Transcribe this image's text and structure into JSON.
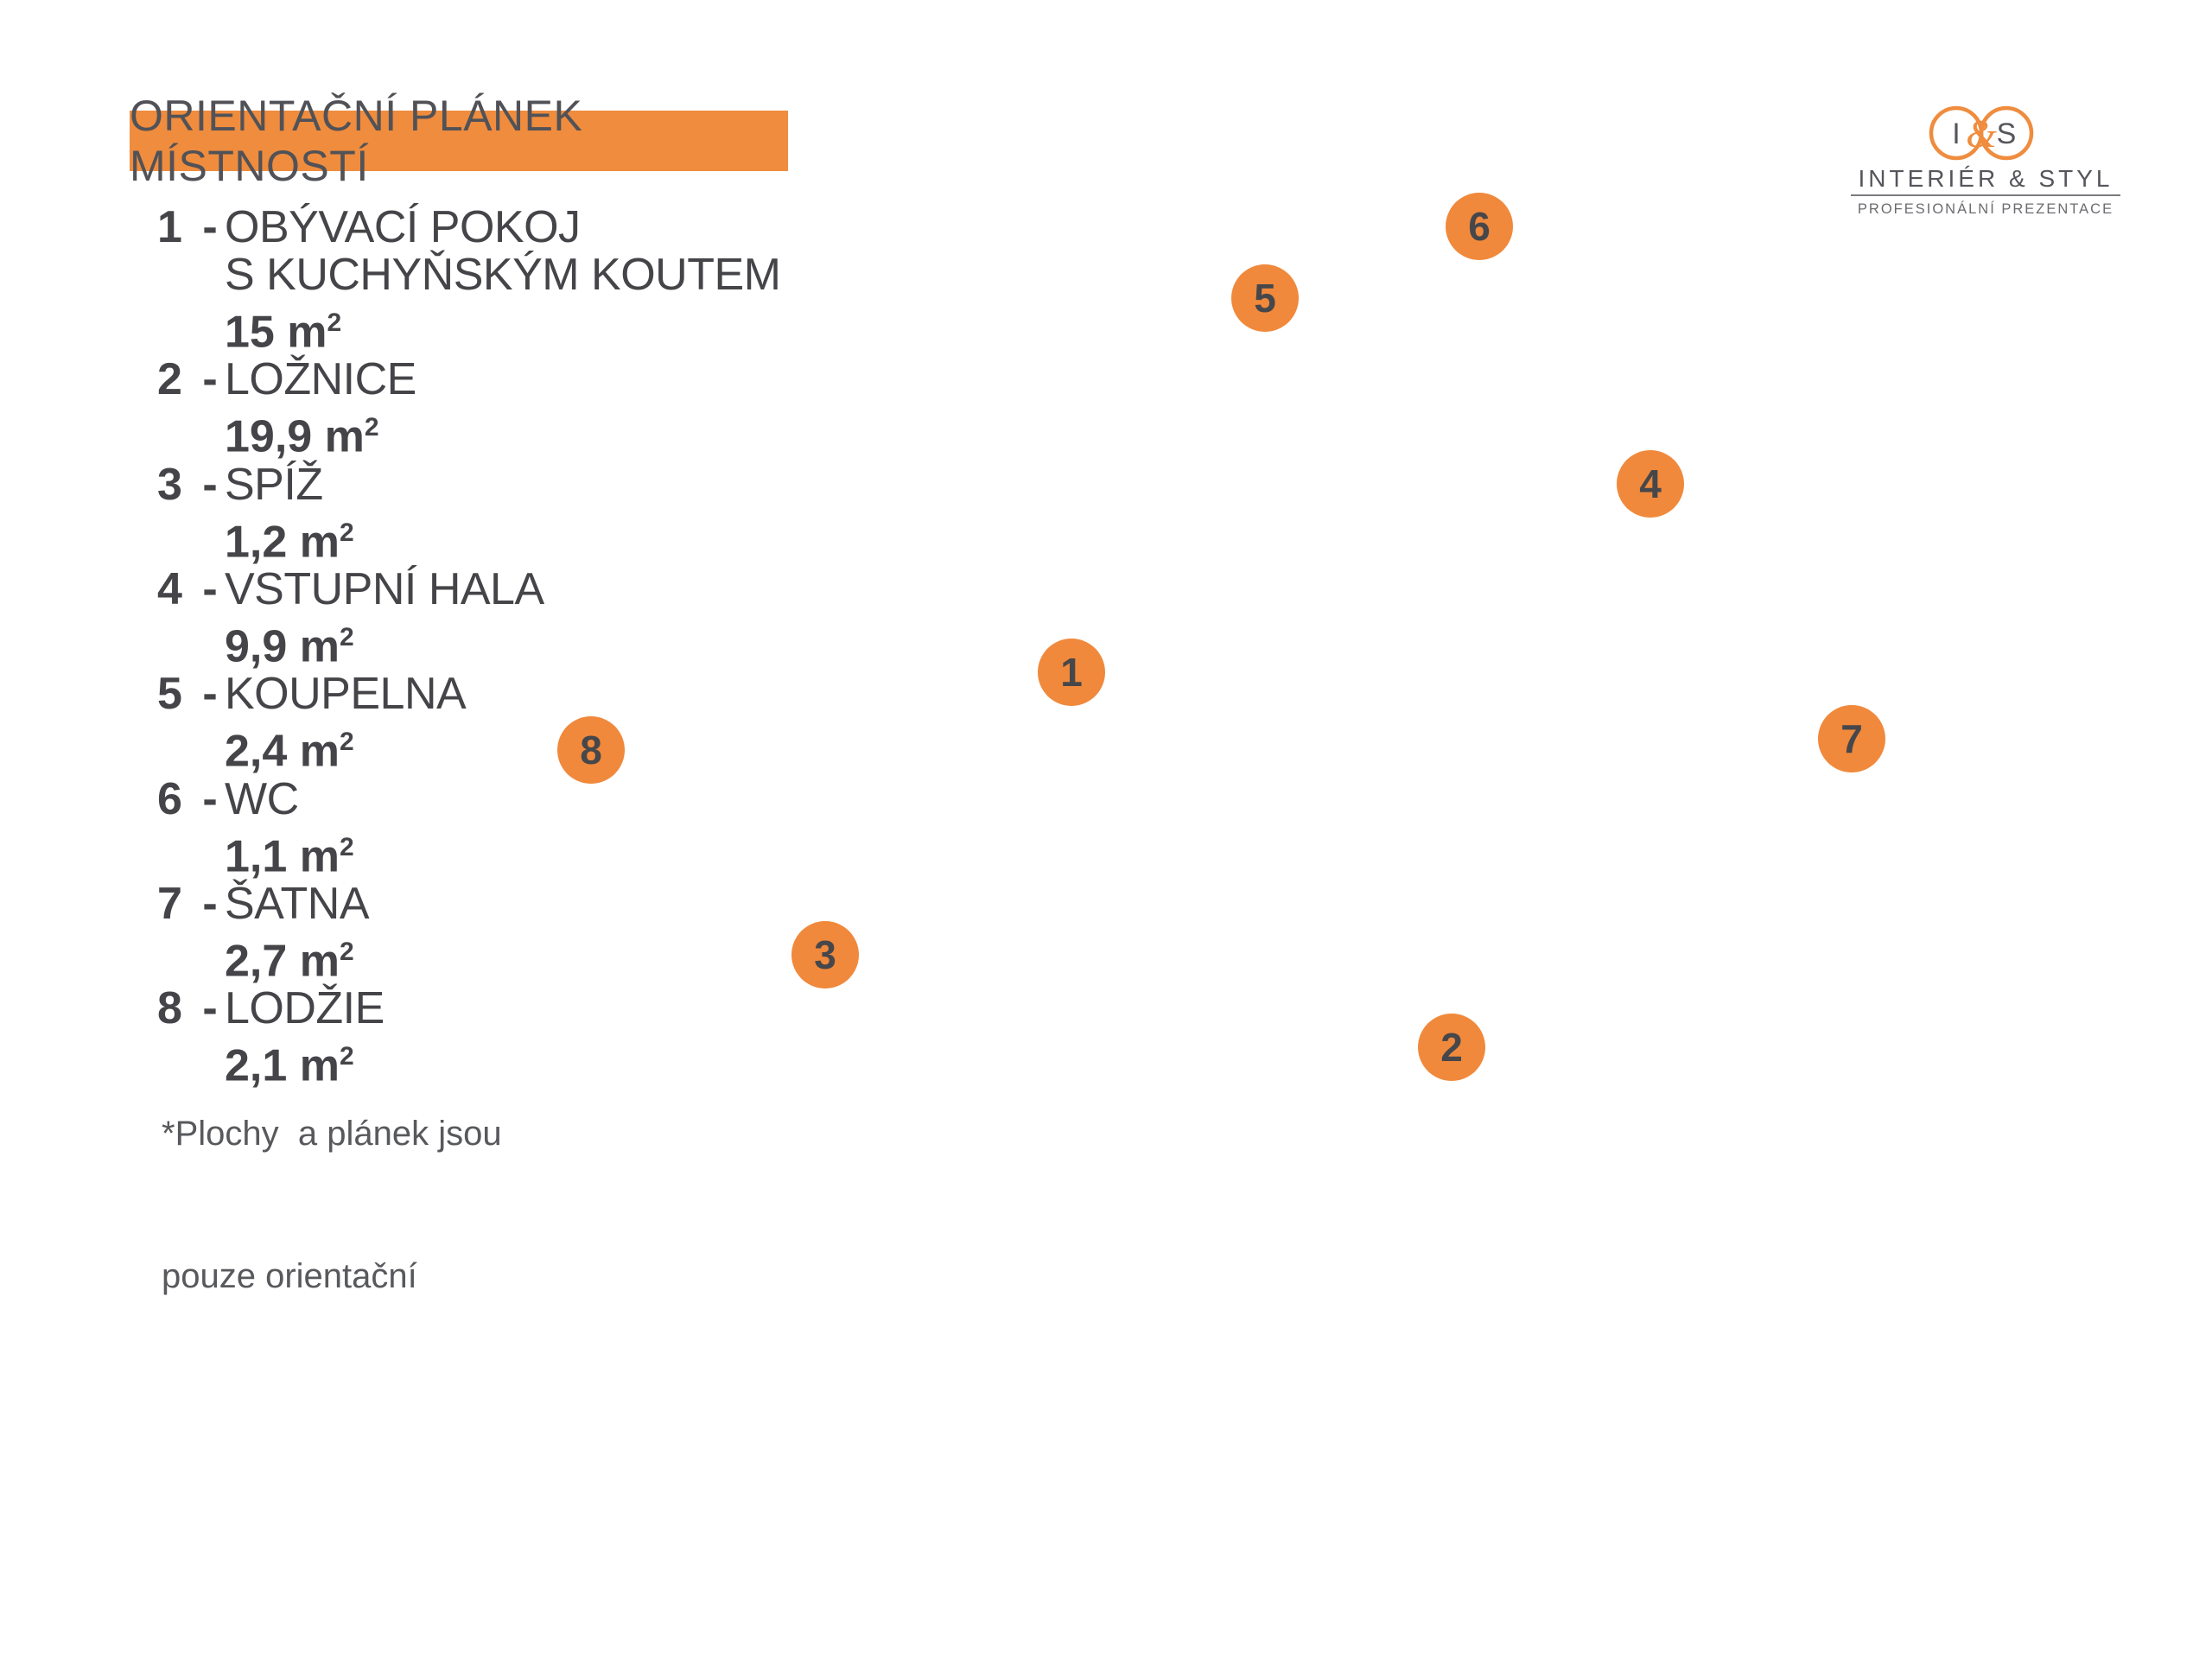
{
  "title_banner": {
    "text": "ORIENTAČNÍ PLÁNEK MÍSTNOSTÍ",
    "bg_color": "#EF8C3E"
  },
  "legend": {
    "items": [
      {
        "num": "1",
        "dash": "-",
        "name1": "OBÝVACÍ POKOJ",
        "name2": "S KUCHYŇSKÝM KOUTEM",
        "area": "15 m",
        "sup": "2"
      },
      {
        "num": "2",
        "dash": "-",
        "name1": "LOŽNICE",
        "area": "19,9 m",
        "sup": "2"
      },
      {
        "num": "3",
        "dash": "-",
        "name1": "SPÍŽ",
        "area": "1,2 m",
        "sup": "2"
      },
      {
        "num": "4",
        "dash": "-",
        "name1": "VSTUPNÍ HALA",
        "area": "9,9 m",
        "sup": "2"
      },
      {
        "num": "5",
        "dash": "-",
        "name1": "KOUPELNA",
        "area": "2,4 m",
        "sup": "2"
      },
      {
        "num": "6",
        "dash": "-",
        "name1": "WC",
        "area": "1,1 m",
        "sup": "2"
      },
      {
        "num": "7",
        "dash": "-",
        "name1": "ŠATNA",
        "area": "2,7 m",
        "sup": "2"
      },
      {
        "num": "8",
        "dash": "-",
        "name1": "LODŽIE",
        "area": "2,1 m",
        "sup": "2"
      }
    ]
  },
  "footnote": {
    "line1": "*Plochy  a plánek jsou",
    "line2": "pouze orientační"
  },
  "logo": {
    "mark_i": "I",
    "mark_amp": "&",
    "mark_s": "S",
    "name": "INTERIÉR & STYL",
    "tagline": "PROFESIONÁLNÍ PREZENTACE"
  },
  "markers": [
    {
      "label": "1"
    },
    {
      "label": "2"
    },
    {
      "label": "3"
    },
    {
      "label": "4"
    },
    {
      "label": "5"
    },
    {
      "label": "6"
    },
    {
      "label": "7"
    },
    {
      "label": "8"
    }
  ],
  "colors": {
    "accent": "#EF8C3E",
    "marker_text": "#46474B",
    "text_dark": "#454549"
  }
}
